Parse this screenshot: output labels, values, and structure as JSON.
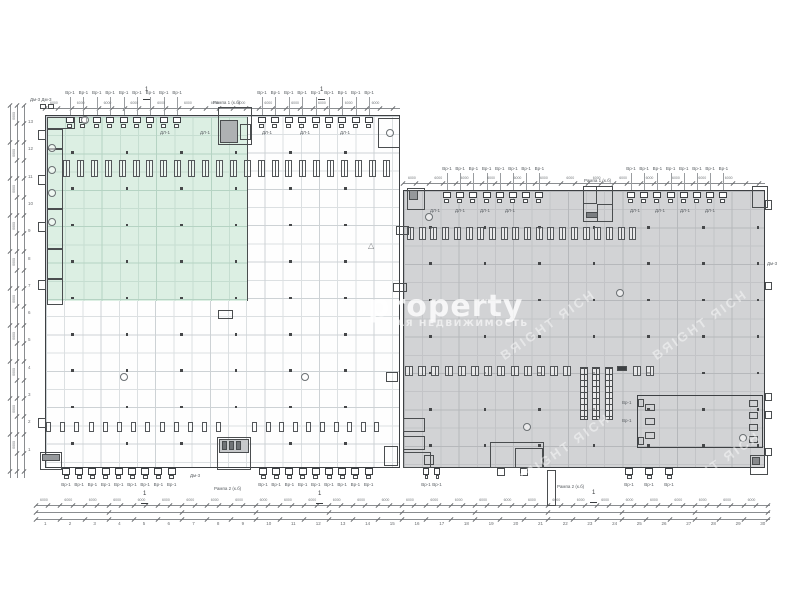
{
  "watermark": {
    "brand": "property",
    "subtitle": "АЯ НЕДВИЖИМОСТЬ",
    "diagonal": "BЯIGHT ЯICH",
    "brand_color": "rgba(255,255,255,0.8)",
    "subtitle_color": "rgba(255,255,255,0.62)",
    "diagonal_color": "rgba(255,255,255,0.45)",
    "diag_positions": [
      [
        548,
        326
      ],
      [
        700,
        326
      ],
      [
        563,
        450
      ],
      [
        713,
        468
      ]
    ]
  },
  "colors": {
    "paper": "#ffffff",
    "wall": "#3d4043",
    "partition": "#4a4d4f",
    "white_fill": "#fefefe",
    "white_grid": "#dce0e2",
    "white_grid_major": "#cdd2d5",
    "gray_fill": "#d2d3d5",
    "gray_grid": "#c3c4c7",
    "gray_grid_major": "#b6b8bb",
    "green_fill": "#dcefe3",
    "green_grid": "#c6ded1",
    "green_grid_major": "#b5d3c3",
    "dim": "#8a8d90",
    "tick": "#6d7073",
    "micro_text": "#5a5f63",
    "column_dot": "#46484a"
  },
  "icons": {
    "warning": "△"
  },
  "labels": {
    "door": "Вр-1",
    "door_inner": "ДЛ-1",
    "dim": "6000",
    "corner": "Дм-3 Дм-3",
    "dm": "Дм-3",
    "ramp1": "Рампа 1 (к.б)",
    "ramp2": "Рампа 2 (к.б)",
    "section": "1"
  },
  "axes": {
    "left": [
      "13",
      "12",
      "11",
      "10",
      "9",
      "8",
      "7",
      "6",
      "5",
      "4",
      "3",
      "2",
      "1"
    ],
    "bottom": [
      "1",
      "2",
      "3",
      "4",
      "5",
      "6",
      "7",
      "8",
      "9",
      "10",
      "11",
      "12",
      "13",
      "14",
      "15",
      "16",
      "17",
      "18",
      "19",
      "20",
      "21",
      "22",
      "23",
      "24",
      "25",
      "26",
      "27",
      "28",
      "29",
      "30"
    ]
  },
  "plan": {
    "buildings": [
      {
        "name": "west",
        "x": 45,
        "y": 115,
        "w": 355,
        "h": 353,
        "kind": "white"
      },
      {
        "name": "east",
        "x": 403,
        "y": 190,
        "w": 362,
        "h": 278,
        "kind": "gray"
      }
    ],
    "green_zone": {
      "x": 47,
      "y": 117,
      "w": 201,
      "h": 184
    },
    "door_groups": [
      {
        "side": "top",
        "wallY": 115,
        "labelY": 91,
        "start": 66,
        "step": 13.4,
        "count": 9
      },
      {
        "side": "top",
        "wallY": 115,
        "labelY": 91,
        "start": 258,
        "step": 13.4,
        "count": 9
      },
      {
        "side": "top",
        "wallY": 190,
        "labelY": 167,
        "start": 443,
        "step": 13.2,
        "count": 8
      },
      {
        "side": "top",
        "wallY": 190,
        "labelY": 167,
        "start": 627,
        "step": 13.2,
        "count": 8
      },
      {
        "side": "bottom",
        "wallY": 468,
        "labelY": 483,
        "start": 62,
        "step": 13.2,
        "count": 9
      },
      {
        "side": "bottom",
        "wallY": 468,
        "labelY": 483,
        "start": 259,
        "step": 13.2,
        "count": 9
      },
      {
        "side": "bottom",
        "wallY": 468,
        "labelY": 483,
        "start": 423,
        "step": 11,
        "count": 2,
        "small": true
      },
      {
        "side": "bottom",
        "wallY": 468,
        "labelY": 483,
        "start": 625,
        "step": 20,
        "count": 3
      }
    ],
    "racks": [
      {
        "x": 63,
        "y": 160,
        "count": 24,
        "step": 13.9,
        "w": 7,
        "h": 17,
        "double": true
      },
      {
        "x": 46,
        "y": 422,
        "count": 13,
        "step": 14.2,
        "w": 5,
        "h": 10
      },
      {
        "x": 252,
        "y": 422,
        "count": 10,
        "step": 13.6,
        "w": 5,
        "h": 10
      },
      {
        "x": 407,
        "y": 227,
        "count": 20,
        "step": 11.7,
        "w": 7,
        "h": 13,
        "double": true
      },
      {
        "x": 405,
        "y": 366,
        "count": 13,
        "step": 13.2,
        "w": 8,
        "h": 10,
        "double": true
      },
      {
        "x": 633,
        "y": 366,
        "count": 2,
        "step": 13,
        "w": 8,
        "h": 10,
        "double": true
      }
    ],
    "rack_columns": [
      {
        "x": 580,
        "y": 367,
        "w": 8,
        "h": 53
      },
      {
        "x": 592,
        "y": 367,
        "w": 8,
        "h": 53
      },
      {
        "x": 605,
        "y": 367,
        "w": 8,
        "h": 53
      }
    ],
    "rooms": [
      [
        47,
        117,
        28,
        12
      ],
      [
        47,
        129,
        16,
        20
      ],
      [
        47,
        149,
        16,
        60
      ],
      [
        47,
        209,
        16,
        40
      ],
      [
        47,
        249,
        16,
        30
      ],
      [
        47,
        279,
        16,
        26
      ],
      [
        40,
        104,
        6,
        5
      ],
      [
        48,
        104,
        6,
        5
      ],
      [
        38,
        130,
        8,
        10
      ],
      [
        38,
        175,
        8,
        10
      ],
      [
        38,
        222,
        8,
        10
      ],
      [
        38,
        280,
        8,
        10
      ],
      [
        38,
        418,
        8,
        10
      ],
      [
        218,
        107,
        34,
        38
      ],
      [
        220,
        120,
        18,
        23,
        "#aeb1b3"
      ],
      [
        240,
        124,
        11,
        16
      ],
      [
        378,
        118,
        22,
        30
      ],
      [
        393,
        283,
        14,
        9
      ],
      [
        396,
        226,
        13,
        9
      ],
      [
        218,
        310,
        15,
        9
      ],
      [
        407,
        188,
        18,
        22
      ],
      [
        409,
        190,
        9,
        10,
        "#95989b"
      ],
      [
        583,
        186,
        30,
        36
      ],
      [
        583,
        186,
        14,
        18
      ],
      [
        597,
        204,
        16,
        18
      ],
      [
        586,
        212,
        12,
        6,
        "#7b7e81"
      ],
      [
        752,
        186,
        16,
        22
      ],
      [
        403,
        418,
        22,
        14
      ],
      [
        403,
        436,
        22,
        14
      ],
      [
        403,
        452,
        28,
        16
      ],
      [
        424,
        455,
        10,
        10
      ],
      [
        384,
        446,
        14,
        20
      ],
      [
        386,
        372,
        12,
        10
      ],
      [
        40,
        452,
        22,
        18
      ],
      [
        42,
        454,
        18,
        7,
        "#96999c"
      ],
      [
        217,
        437,
        34,
        33
      ],
      [
        219,
        439,
        30,
        14,
        "#c7c9cb"
      ],
      [
        222,
        441,
        5,
        9,
        "#707376"
      ],
      [
        229,
        441,
        5,
        9,
        "#707376"
      ],
      [
        236,
        441,
        5,
        9,
        "#707376"
      ],
      [
        490,
        442,
        54,
        26
      ],
      [
        515,
        448,
        28,
        20
      ],
      [
        497,
        468,
        8,
        8
      ],
      [
        520,
        468,
        8,
        8
      ],
      [
        547,
        470,
        9,
        36
      ],
      [
        750,
        455,
        18,
        20
      ],
      [
        752,
        457,
        8,
        8,
        "#87898c"
      ],
      [
        765,
        200,
        7,
        10
      ],
      [
        765,
        282,
        7,
        8
      ],
      [
        765,
        393,
        7,
        8
      ],
      [
        765,
        411,
        7,
        8
      ],
      [
        765,
        448,
        7,
        8
      ],
      [
        637,
        395,
        126,
        53,
        null,
        1
      ],
      [
        645,
        404,
        10,
        7
      ],
      [
        645,
        418,
        10,
        7
      ],
      [
        645,
        432,
        10,
        7
      ],
      [
        749,
        400,
        9,
        7
      ],
      [
        749,
        412,
        9,
        7
      ],
      [
        749,
        424,
        9,
        7
      ],
      [
        749,
        436,
        9,
        7
      ],
      [
        638,
        399,
        6,
        8
      ],
      [
        638,
        437,
        6,
        8
      ],
      [
        617,
        366,
        10,
        5,
        "#3d4043"
      ]
    ],
    "bubbles": [
      [
        85,
        120
      ],
      [
        52,
        148
      ],
      [
        52,
        170
      ],
      [
        52,
        193
      ],
      [
        52,
        222
      ],
      [
        124,
        377
      ],
      [
        305,
        377
      ],
      [
        390,
        133
      ],
      [
        620,
        293
      ],
      [
        527,
        427
      ],
      [
        743,
        438
      ],
      [
        429,
        217
      ]
    ],
    "warning_pos": [
      368,
      241
    ],
    "flags": [
      [
        143,
        93
      ],
      [
        318,
        93
      ],
      [
        141,
        497
      ],
      [
        316,
        497
      ],
      [
        590,
        496
      ]
    ],
    "microlabels": [
      [
        30,
        98,
        "corner"
      ],
      [
        213,
        101,
        "ramp1"
      ],
      [
        584,
        179,
        "ramp1"
      ],
      [
        214,
        487,
        "ramp2"
      ],
      [
        557,
        485,
        "ramp2"
      ],
      [
        767,
        262,
        "dm"
      ],
      [
        622,
        401,
        "door"
      ],
      [
        622,
        419,
        "door"
      ],
      [
        190,
        474,
        "dm"
      ],
      [
        160,
        131,
        "door_inner"
      ],
      [
        200,
        131,
        "door_inner"
      ],
      [
        262,
        131,
        "door_inner"
      ],
      [
        300,
        131,
        "door_inner"
      ],
      [
        340,
        131,
        "door_inner"
      ],
      [
        430,
        209,
        "door_inner"
      ],
      [
        455,
        209,
        "door_inner"
      ],
      [
        480,
        209,
        "door_inner"
      ],
      [
        505,
        209,
        "door_inner"
      ],
      [
        630,
        209,
        "door_inner"
      ],
      [
        655,
        209,
        "door_inner"
      ],
      [
        680,
        209,
        "door_inner"
      ],
      [
        705,
        209,
        "door_inner"
      ]
    ],
    "dims": {
      "h": [
        [
          505,
          36,
          770,
          12.2
        ],
        [
          512,
          36,
          770,
          73.2
        ],
        [
          519,
          36,
          770,
          24.4
        ],
        [
          108,
          45,
          400,
          13.4
        ],
        [
          183,
          403,
          765,
          13.2
        ]
      ],
      "v": [
        [
          10,
          105,
          478,
          36.6
        ],
        [
          17,
          105,
          478,
          18.3
        ],
        [
          24,
          105,
          478,
          18.3
        ]
      ],
      "bottom_nums": {
        "x0": 44,
        "step": 24.7,
        "y": 522
      },
      "left_nums": {
        "x": 28,
        "y0": 120,
        "step": 27.3
      },
      "bottom_dimtext": {
        "x0": 40,
        "y": 499,
        "step": 24.4,
        "count": 30
      },
      "left_dimtext": {
        "x": 11,
        "y0": 112,
        "step": 36.6,
        "count": 10
      },
      "top_dimtext": [
        [
          50,
          102,
          26.8,
          13
        ],
        [
          408,
          177,
          26.4,
          13
        ]
      ]
    },
    "dots": [
      {
        "x0": 72,
        "y0": 152,
        "sx": 54.6,
        "sy": 36.4,
        "nx": 6,
        "ny": 9
      },
      {
        "x0": 430,
        "y0": 227,
        "sx": 54.6,
        "sy": 36.4,
        "nx": 7,
        "ny": 7
      }
    ]
  }
}
